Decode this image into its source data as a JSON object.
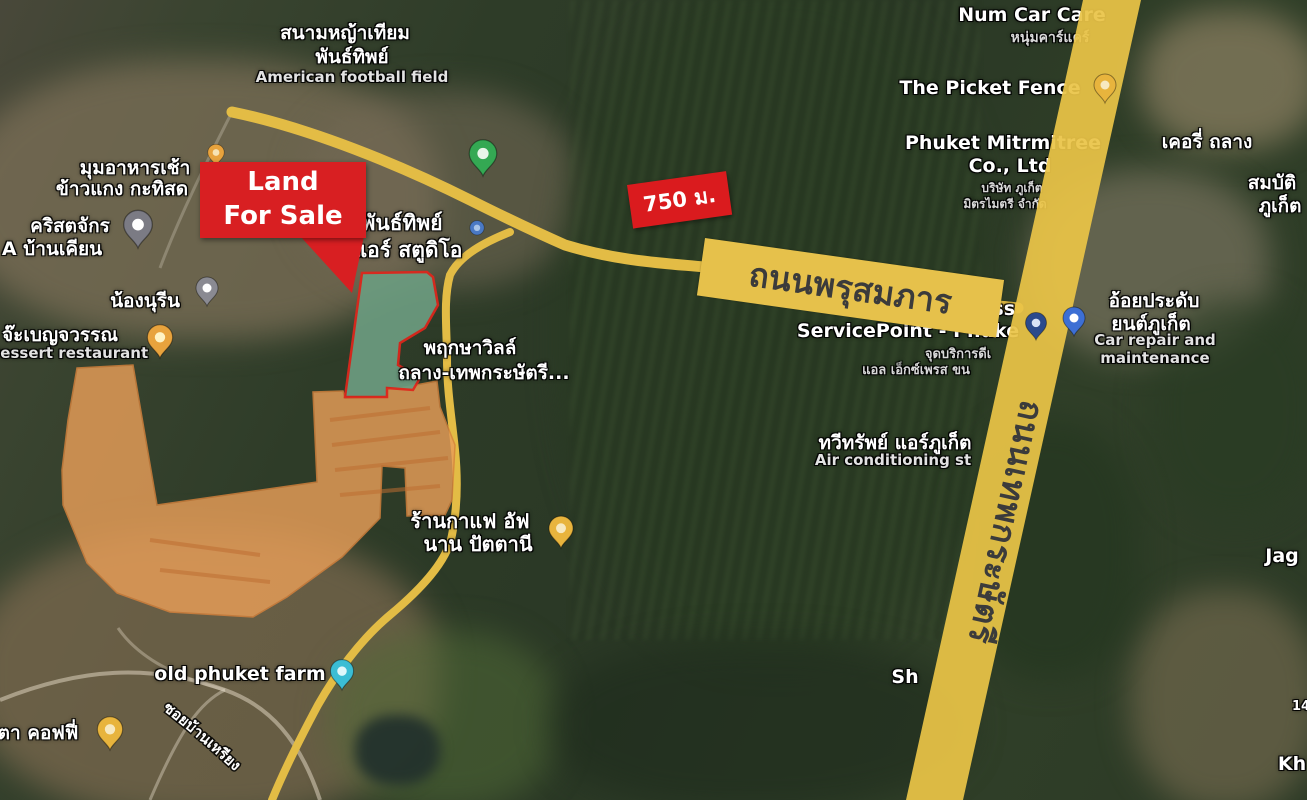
{
  "annotations": {
    "land_for_sale": {
      "label": "Land For Sale"
    },
    "distance_badge": {
      "label": "750 ม."
    }
  },
  "roads": {
    "phrusomphan": {
      "label": "ถนนพรุสมภาร",
      "text_color": "#3b3b3b"
    },
    "thepkrasattri": {
      "label": "ถนนเทพกระษัตรี",
      "text_color": "#3b3b3b"
    },
    "soi_ban_riang": {
      "label": "ซอยบ้านเหรียง"
    }
  },
  "colors": {
    "land_plot_fill": "#6c9c80",
    "land_plot_outline": "#e0261c",
    "development_fill": "#e89e58",
    "development_outline": "#d6823c",
    "road_yellow": "#eac447",
    "minor_road_yellow": "#e3bc45",
    "callout_red": "#d81f22",
    "label_white": "#ffffff"
  },
  "map_labels": [
    {
      "name": "football-field-label-th-1",
      "text": "สนามหญ้าเทียม",
      "x": 345,
      "y": 18,
      "size": 19,
      "color": "#ffffff"
    },
    {
      "name": "football-field-label-th-2",
      "text": "พันธ์ทิพย์",
      "x": 352,
      "y": 42,
      "size": 19,
      "color": "#ffffff"
    },
    {
      "name": "football-field-label-en",
      "text": "American football field",
      "x": 352,
      "y": 68,
      "size": 15,
      "color": "#e2e2e2"
    },
    {
      "name": "num-car-care-label",
      "text": "Num Car Care",
      "x": 1032,
      "y": 4,
      "size": 19,
      "color": "#ffffff"
    },
    {
      "name": "num-car-care-label-th",
      "text": "หนุ่มคาร์แคร์",
      "x": 1050,
      "y": 27,
      "size": 14,
      "color": "#d8d8d8"
    },
    {
      "name": "picket-fence-label",
      "text": "The Picket Fence",
      "x": 990,
      "y": 77,
      "size": 19,
      "color": "#ffffff"
    },
    {
      "name": "mitrmitree-label-1",
      "text": "Phuket Mitrmitree",
      "x": 1003,
      "y": 132,
      "size": 19,
      "color": "#ffffff"
    },
    {
      "name": "mitrmitree-label-2",
      "text": "Co., Ltd",
      "x": 1010,
      "y": 155,
      "size": 19,
      "color": "#ffffff"
    },
    {
      "name": "mitrmitree-label-th-1",
      "text": "บริษัท ภูเก็ต",
      "x": 1012,
      "y": 179,
      "size": 12,
      "color": "#d8d8d8"
    },
    {
      "name": "mitrmitree-label-th-2",
      "text": "มิตรไมตรี จำกัด",
      "x": 1005,
      "y": 195,
      "size": 12,
      "color": "#d8d8d8"
    },
    {
      "name": "kerry-thalang-label",
      "text": "เคอรี่ ถลาง",
      "x": 1207,
      "y": 127,
      "size": 19,
      "color": "#ffffff"
    },
    {
      "name": "sombat-label-1",
      "text": "สมบัติ",
      "x": 1272,
      "y": 168,
      "size": 19,
      "color": "#ffffff"
    },
    {
      "name": "sombat-label-2",
      "text": "ภูเก็ต",
      "x": 1280,
      "y": 191,
      "size": 19,
      "color": "#ffffff"
    },
    {
      "name": "breakfast-label-1",
      "text": "มุมอาหารเช้า",
      "x": 135,
      "y": 153,
      "size": 19,
      "color": "#ffffff"
    },
    {
      "name": "breakfast-label-2",
      "text": "ข้าวแกง กะทิสด",
      "x": 122,
      "y": 174,
      "size": 19,
      "color": "#ffffff"
    },
    {
      "name": "church-label-1",
      "text": "คริสตจักร",
      "x": 70,
      "y": 211,
      "size": 19,
      "color": "#ffffff"
    },
    {
      "name": "church-label-2",
      "text": "A บ้านเคียน",
      "x": 52,
      "y": 234,
      "size": 19,
      "color": "#ffffff"
    },
    {
      "name": "nong-nureen-label",
      "text": "น้องนุรีน",
      "x": 145,
      "y": 286,
      "size": 19,
      "color": "#ffffff"
    },
    {
      "name": "dessert-label-th",
      "text": "จ๊ะเบญจวรรณ",
      "x": 60,
      "y": 320,
      "size": 19,
      "color": "#ffffff"
    },
    {
      "name": "dessert-label-en",
      "text": "Dessert restaurant",
      "x": 68,
      "y": 344,
      "size": 15,
      "color": "#e2e2e2"
    },
    {
      "name": "air-studio-label-1",
      "text": "พันธ์ทิพย์",
      "x": 402,
      "y": 207,
      "size": 21,
      "color": "#ffffff"
    },
    {
      "name": "air-studio-label-2",
      "text": "แอร์ สตูดิโอ",
      "x": 408,
      "y": 234,
      "size": 21,
      "color": "#ffffff"
    },
    {
      "name": "pruksa-ville-label-1",
      "text": "พฤกษาวิลล์",
      "x": 470,
      "y": 333,
      "size": 19,
      "color": "#ffffff"
    },
    {
      "name": "pruksa-ville-label-2",
      "text": "ถลาง-เทพกระษัตรี...",
      "x": 484,
      "y": 358,
      "size": 19,
      "color": "#ffffff"
    },
    {
      "name": "air-phuket-label-th",
      "text": "ทวีทรัพย์ แอร์ภูเก็ต",
      "x": 895,
      "y": 428,
      "size": 19,
      "color": "#ffffff"
    },
    {
      "name": "air-phuket-label-en",
      "text": "Air conditioning st",
      "x": 893,
      "y": 451,
      "size": 15,
      "color": "#e2e2e2"
    },
    {
      "name": "dhl-label-1",
      "text": "DHL Express",
      "x": 948,
      "y": 298,
      "size": 19,
      "color": "#ffffff"
    },
    {
      "name": "dhl-label-2",
      "text": "ServicePoint - Phuke",
      "x": 908,
      "y": 320,
      "size": 19,
      "color": "#ffffff"
    },
    {
      "name": "dhl-label-th-1",
      "text": "จุดบริการดีเ",
      "x": 958,
      "y": 343,
      "size": 13,
      "color": "#d8d8d8"
    },
    {
      "name": "dhl-label-th-2",
      "text": "แอล เอ็กซ์เพรส ขน",
      "x": 916,
      "y": 359,
      "size": 13,
      "color": "#d8d8d8"
    },
    {
      "name": "car-repair-label-th-1",
      "text": "อ้อยประดับ",
      "x": 1154,
      "y": 286,
      "size": 19,
      "color": "#ffffff"
    },
    {
      "name": "car-repair-label-th-2",
      "text": "ยนต์ภูเก็ต",
      "x": 1151,
      "y": 309,
      "size": 19,
      "color": "#ffffff"
    },
    {
      "name": "car-repair-label-en-1",
      "text": "Car repair and",
      "x": 1155,
      "y": 331,
      "size": 15,
      "color": "#e2e2e2"
    },
    {
      "name": "car-repair-label-en-2",
      "text": "maintenance",
      "x": 1155,
      "y": 349,
      "size": 15,
      "color": "#e2e2e2"
    },
    {
      "name": "coffee-afnan-label-1",
      "text": "ร้านกาแฟ อัฟ",
      "x": 470,
      "y": 505,
      "size": 20,
      "color": "#ffffff"
    },
    {
      "name": "coffee-afnan-label-2",
      "text": "นาน ปัตตานี",
      "x": 478,
      "y": 528,
      "size": 20,
      "color": "#ffffff"
    },
    {
      "name": "old-phuket-farm-label",
      "text": "old phuket farm",
      "x": 240,
      "y": 663,
      "size": 19,
      "color": "#ffffff"
    },
    {
      "name": "ta-coffee-label",
      "text": "ตา คอฟฟี่",
      "x": 38,
      "y": 718,
      "size": 19,
      "color": "#ffffff"
    },
    {
      "name": "jag-label",
      "text": "Jag",
      "x": 1282,
      "y": 545,
      "size": 19,
      "color": "#ffffff"
    },
    {
      "name": "sh-label",
      "text": "Sh",
      "x": 905,
      "y": 666,
      "size": 19,
      "color": "#ffffff"
    },
    {
      "name": "kh-label",
      "text": "Kh",
      "x": 1292,
      "y": 753,
      "size": 19,
      "color": "#ffffff"
    },
    {
      "name": "number-label",
      "text": "14",
      "x": 1301,
      "y": 699,
      "size": 13,
      "color": "#ffffff"
    }
  ],
  "markers": [
    {
      "name": "football-field-pin",
      "x": 483,
      "y": 176,
      "color": "#34a853",
      "inner": "#e8f5e9",
      "scale": 1.25
    },
    {
      "name": "orange-dot-pin",
      "x": 216,
      "y": 166,
      "color": "#e8a33d",
      "inner": "#f7e3b3",
      "scale": 0.75
    },
    {
      "name": "church-pin",
      "x": 138,
      "y": 248,
      "color": "#7b7b84",
      "inner": "#ffffff",
      "scale": 1.3
    },
    {
      "name": "nong-nureen-pin",
      "x": 207,
      "y": 306,
      "color": "#8a8a92",
      "inner": "#ffffff",
      "scale": 1.0
    },
    {
      "name": "dessert-restaurant-pin",
      "x": 160,
      "y": 358,
      "color": "#e8a33d",
      "inner": "#fff3c4",
      "scale": 1.15
    },
    {
      "name": "blue-dot-marker",
      "x": 477,
      "y": 235,
      "color": "#4a79c4",
      "inner": "#a8c4e8",
      "scale": 0.8,
      "dot": true
    },
    {
      "name": "road-yellow-pin",
      "x": 1105,
      "y": 103,
      "color": "#e8b43d",
      "inner": "#f7e9c0",
      "scale": 1.0
    },
    {
      "name": "dhl-pin",
      "x": 1036,
      "y": 340,
      "color": "#2b4a8c",
      "inner": "#d8e2f5",
      "scale": 0.95
    },
    {
      "name": "car-repair-pin",
      "x": 1074,
      "y": 336,
      "color": "#3d6fd4",
      "inner": "#ffffff",
      "scale": 1.0
    },
    {
      "name": "coffee-shop-pin",
      "x": 561,
      "y": 548,
      "color": "#e8b43d",
      "inner": "#f7e9c0",
      "scale": 1.1
    },
    {
      "name": "old-phuket-farm-pin",
      "x": 342,
      "y": 690,
      "color": "#3bbdd4",
      "inner": "#e0f7fa",
      "scale": 1.05
    },
    {
      "name": "coffee-pin-southwest",
      "x": 110,
      "y": 750,
      "color": "#e8b43d",
      "inner": "#f7e9c0",
      "scale": 1.15
    }
  ]
}
